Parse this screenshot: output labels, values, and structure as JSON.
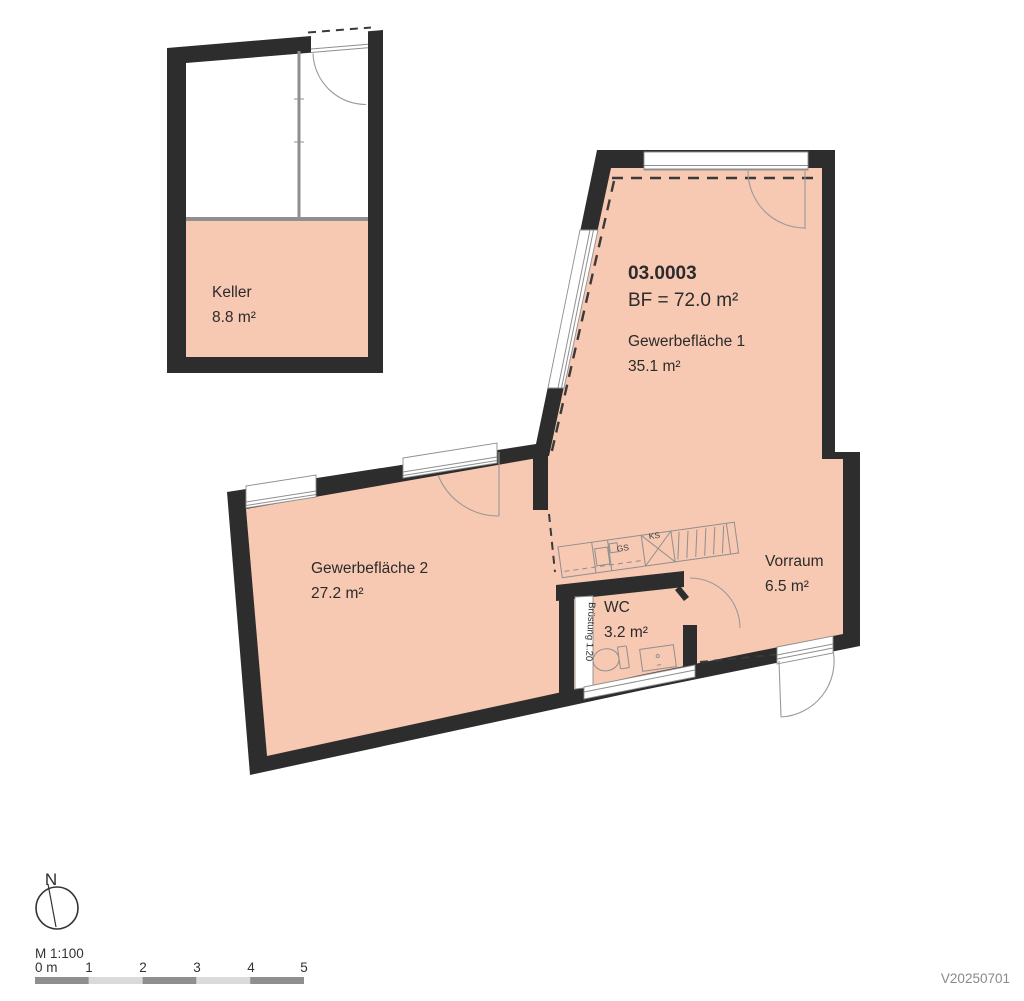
{
  "colors": {
    "room_fill": "#f7c8b2",
    "wall": "#2d2d2d",
    "line_gray": "#8f8f8f",
    "bar_dark": "#8f8f8f",
    "bar_light": "#dadada"
  },
  "plan": {
    "unit_id": "03.0003",
    "unit_bf": "BF = 72.0 m²",
    "rooms": {
      "keller": {
        "name": "Keller",
        "area": "8.8 m²"
      },
      "gewerbeflaeche1": {
        "name": "Gewerbefläche 1",
        "area": "35.1 m²"
      },
      "gewerbeflaeche2": {
        "name": "Gewerbefläche 2",
        "area": "27.2 m²"
      },
      "wc": {
        "name": "WC",
        "area": "3.2 m²"
      },
      "vorraum": {
        "name": "Vorraum",
        "area": "6.5 m²"
      }
    },
    "annotations": {
      "parapet": "Brüstung 1.20",
      "kitchen_gs": "GS",
      "kitchen_ks": "KS"
    }
  },
  "legend": {
    "north_label": "N",
    "scale_label": "M 1:100",
    "scale_ticks": [
      "0 m",
      "1",
      "2",
      "3",
      "4",
      "5"
    ],
    "version": "V20250701"
  }
}
